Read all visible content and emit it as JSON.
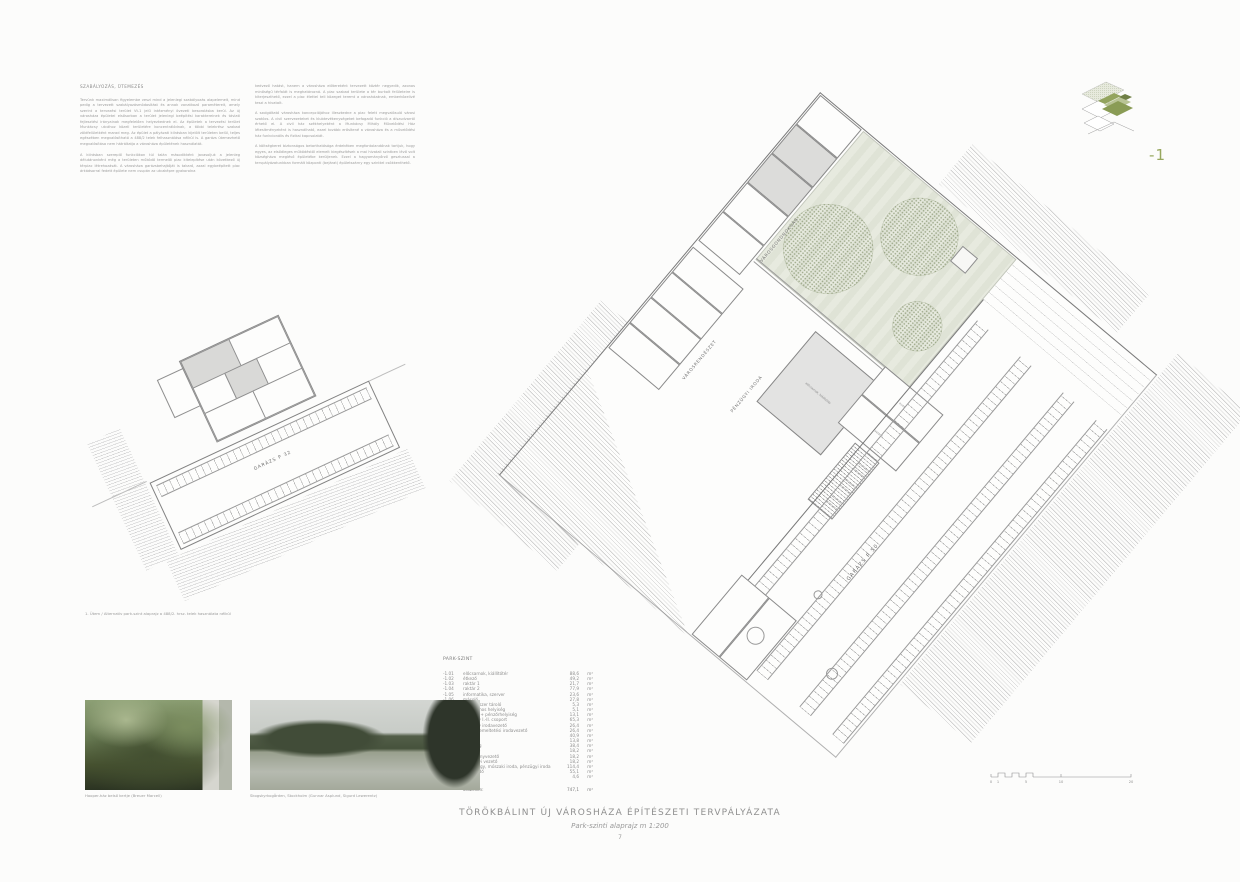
{
  "sheet": {
    "title": "TÖRÖKBÁLINT ÚJ VÁROSHÁZA ÉPÍTÉSZETI TERVPÁLYÁZATA",
    "subtitle": "Park-szinti alaprajz m 1:200",
    "page_number": "7"
  },
  "intro": {
    "heading": "SZABÁLYOZÁS, ÜTEMEZÉS",
    "col1": [
      "Tervünk maximálisan figyelembe veszi mind a jelenlegi szabályozás alapelemeit, mind pedig a tervezett szabályozásmódosítást és annak vonatkozó paramétereit, amely szerint a tervezési terület Vt-1 jelű intézményi övezeti besorolásba kerül. Az új városháza épületei elsősorban a terület jelenlegi beépítési karaktereinek és távlati fejlesztési irányainak megfelelően helyezkednek el. Az épületek a tervezési terület Munkácsy utcához közeli területére koncentrálódnak, a többi telekrész szabad zöldfelületként marad meg. Az épület a pályázati kiírásban kijelölt területen belül, teljes egészében megvalósítható a 488/2 telek felhasználása nélkül is. A garázs ütemezhető megvalósítása nem hátráltatja a városháza épületének használatát.",
      "A kiírásban szereplő funkciókon túl talán másodikként javasoljuk a jelenleg délutánonként még a területen működő termelői piac kitelepítése után következő új térpiac létrehozását. A városháza garázsbehajtóját is takaró, azzal egybeépített piac árkádsorral fedett épülete nem csupán az utcaképre gyakorolna"
    ],
    "col2": [
      "kedvező hatást, hanem a városháza előtereként tervezett köztér negyedik, azonos minőségű térfalát is meghatározná. A piac szabad területe a tér burkolt felületeire is kiterjeszthető, ezzel a piac élettel teli közeget teremt a városházának, emberközelivé teszi a hivatalt.",
      "A szolgáltató városháza koncepciójához illeszkedne a piac felett megvalósuló városi szatócs. A civil szervezeteket és klubtevékenységeket befogadó funkció a díszudvarról érhető el. A civil ház székhelyeként a Munkácsy Mihály Művelődési Ház létesítményeként is használható, ezzel tovább erősítené a városháza és a művelődési ház funkcionális és fizikai kapcsolatát.",
      "A költségkeret biztonságos betarthatósága érdekében megfontolandónak tartjuk, hogy egyes, az elsődleges működéstől elemelt kiegészítések a mai hivatali szintben lévő volt községháza meglévő épületébe kerüljenek. Ezzel a hagyományőrző gesztussal a tervpályázatunkban formált központi (bejárat) épületszárny egy szinttel csökkenthető."
    ]
  },
  "key_plan": {
    "level_label": "-1"
  },
  "main_plan": {
    "labels": {
      "gondnoksag": "VÁROSGONDNOKSÁG",
      "rendeszet": "VÁROSRENDÉSZET",
      "penzugyi": "PÉNZÜGYI IRODA",
      "garage": "GARÁZS P 50"
    },
    "rooms": {
      "hall": "előcsarnok, kiállítótér",
      "office": "iroda",
      "storage": "raktár 1"
    }
  },
  "alt_plan": {
    "garage_label": "GARÁZS P 32",
    "caption": "1. Ütem / Alternatív park-szint alaprajz a 488/2. hrsz. telek használata nélkül"
  },
  "legend": {
    "heading": "PARK-SZINT",
    "unit": "m²",
    "rows": [
      {
        "code": "-1.01",
        "name": "előcsarnok, kiállítótér",
        "area": "88,6"
      },
      {
        "code": "-1.02",
        "name": "étkező",
        "area": "49,2"
      },
      {
        "code": "-1.03",
        "name": "raktár 1",
        "area": "21,7"
      },
      {
        "code": "-1.04",
        "name": "raktár 2",
        "area": "77,9"
      },
      {
        "code": "-1.05",
        "name": "informatika, szerver",
        "area": "23,6"
      },
      {
        "code": "-1.06",
        "name": "másoló",
        "area": "27,8"
      },
      {
        "code": "-1.07",
        "name": "takarítószer tároló",
        "area": "5,3"
      },
      {
        "code": "-1.08",
        "name": "elektromos helyiség",
        "area": "5,1"
      },
      {
        "code": "-1.09",
        "name": "pénztár + pénzőrhelyiség",
        "area": "13,1"
      },
      {
        "code": "-1.10",
        "name": "pénzügy I.-II. csoport",
        "area": "65,3"
      },
      {
        "code": "-1.11",
        "name": "pénzügy irodavezető",
        "area": "26,4"
      },
      {
        "code": "-1.12",
        "name": "városüzemeltetési irodavezető",
        "area": "26,4"
      },
      {
        "code": "-1.13",
        "name": "iroda",
        "area": "40,9"
      },
      {
        "code": "-1.14",
        "name": "jegyző",
        "area": "13,8"
      },
      {
        "code": "-1.15",
        "name": "titkárság",
        "area": "38,4"
      },
      {
        "code": "-1.16",
        "name": "tárgyaló",
        "area": "18,2"
      },
      {
        "code": "-1.17",
        "name": "intézményvezető",
        "area": "18,2"
      },
      {
        "code": "-1.18",
        "name": "pénzügyi vezető",
        "area": "18,2"
      },
      {
        "code": "-1.19",
        "name": "munkaügy, műszaki iroda, pénzügyi iroda",
        "area": "114,4"
      },
      {
        "code": "-1.20",
        "name": "közlekedő",
        "area": "55,1"
      },
      {
        "code": "-1.21",
        "name": "előtér",
        "area": "4,6"
      }
    ],
    "total_label": "összesen:",
    "total_area": "747,1"
  },
  "photos": [
    {
      "caption": "Hooper-ház belső kertje (Breuer Marcell)"
    },
    {
      "caption": "Skogskyrkogården, Stockholm (Gunnar Asplund, Sigurd Lewerentz)"
    }
  ],
  "scale_bar": {
    "labels": [
      "0",
      "1",
      "5",
      "10",
      "20"
    ]
  },
  "colors": {
    "accent_green": "#97a75e",
    "courtyard_green": "#dfe3d6",
    "line_gray": "#9a9a9a"
  }
}
